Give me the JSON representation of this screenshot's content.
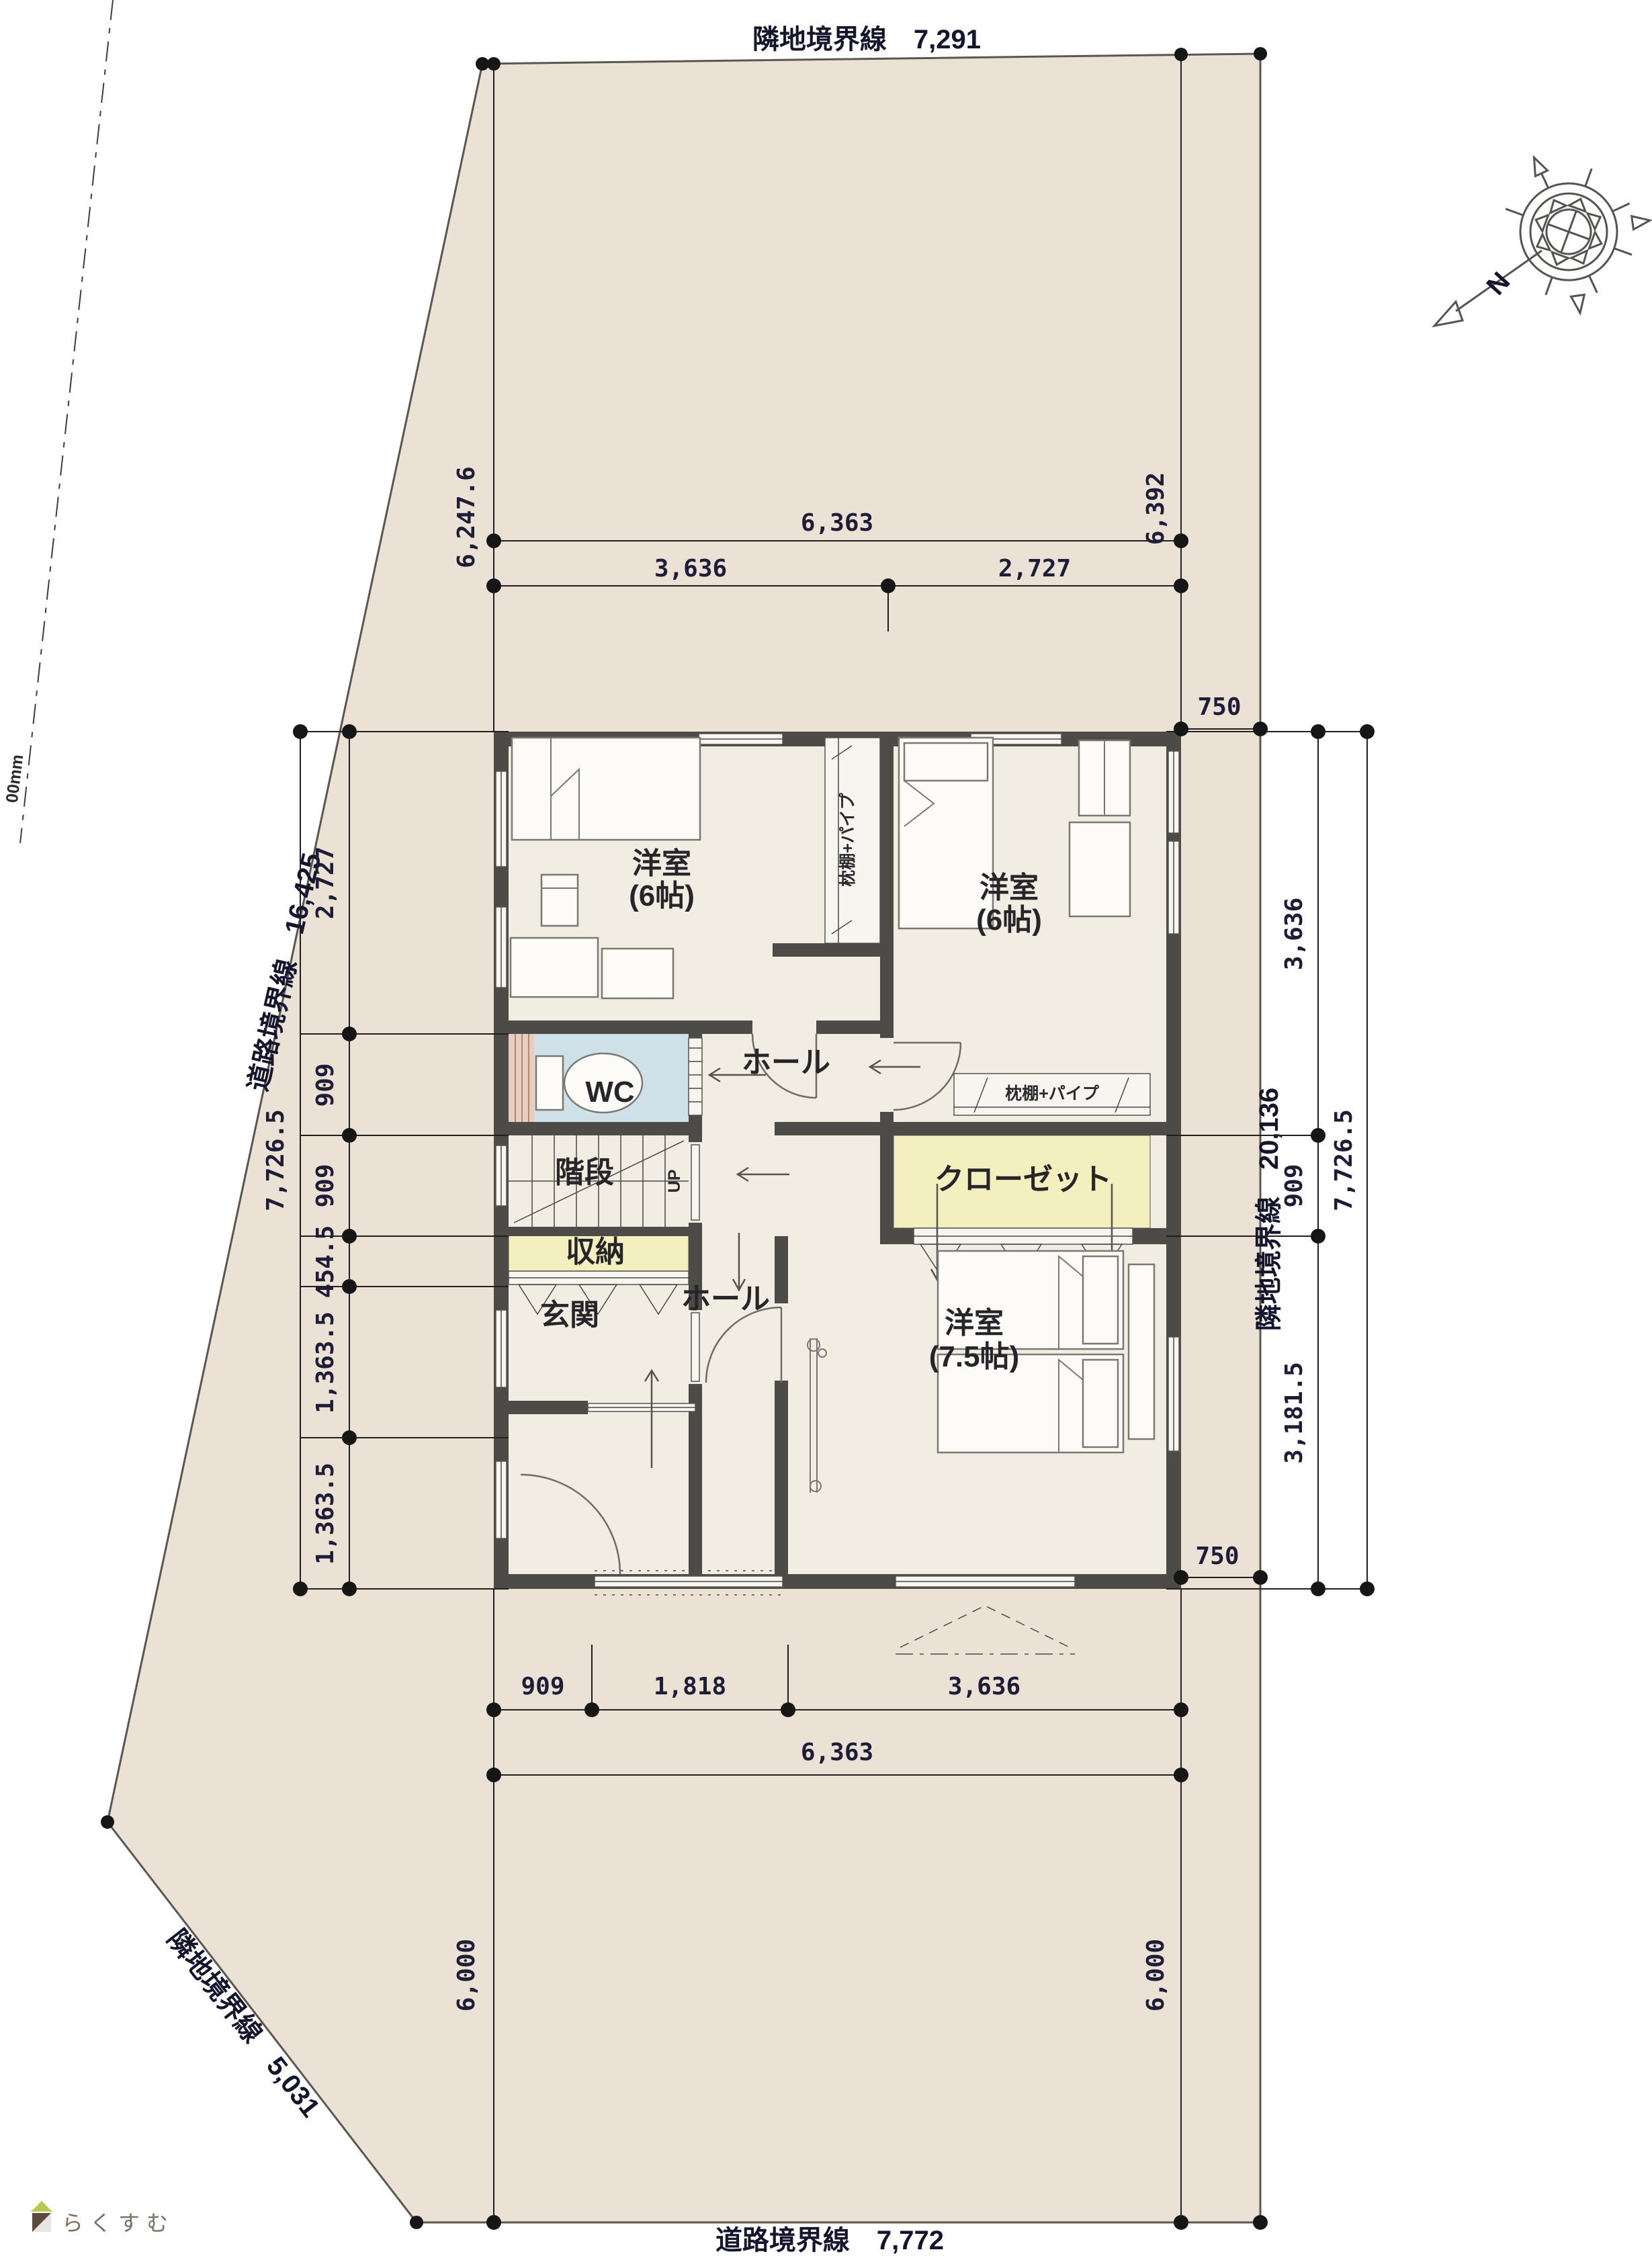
{
  "boundaries": {
    "top": "隣地境界線　7,291",
    "left": "道路境界線　16,425",
    "lower_left": "隣地境界線　5,031",
    "bottom": "道路境界線　7,772",
    "right": "隣地境界線　20,136",
    "edge_note": "00mm"
  },
  "dims": {
    "top_left_v": "6,247.6",
    "top_right_v": "6,392",
    "top_w": "6,363",
    "top_w1": "3,636",
    "top_w2": "2,727",
    "right_offset_top": "750",
    "right_offset_bottom": "750",
    "left_chain": [
      "2,727",
      "909",
      "909",
      "454.5",
      "1,363.5",
      "1,363.5"
    ],
    "left_total": "7,726.5",
    "right_chain": [
      "3,636",
      "909",
      "3,181.5"
    ],
    "right_total": "7,726.5",
    "bottom_chain": [
      "909",
      "1,818",
      "3,636"
    ],
    "bottom_w": "6,363",
    "bottom_left_v": "6,000",
    "bottom_right_v": "6,000"
  },
  "rooms": {
    "room_nw": {
      "name": "洋室",
      "size": "(6帖)"
    },
    "room_ne": {
      "name": "洋室",
      "size": "(6帖)"
    },
    "room_s": {
      "name": "洋室",
      "size": "(7.5帖)"
    },
    "wc": "WC",
    "hall_upper": "ホール",
    "hall_lower": "ホール",
    "stairs": "階段",
    "up": "UP",
    "storage": "収納",
    "entrance": "玄関",
    "closet": "クローゼット",
    "shelf_nw": "枕棚+パイプ",
    "shelf_ne": "枕棚+パイプ"
  },
  "compass": {
    "north": "N"
  },
  "watermark": "らくすむ",
  "colors": {
    "site": "#ebe2d5",
    "floor": "#f2ede3",
    "wall": "#4d4b47",
    "wc_blue": "#cfe1e8",
    "closet_yellow": "#f3efbe",
    "counter_pink": "#e9cdbf"
  }
}
